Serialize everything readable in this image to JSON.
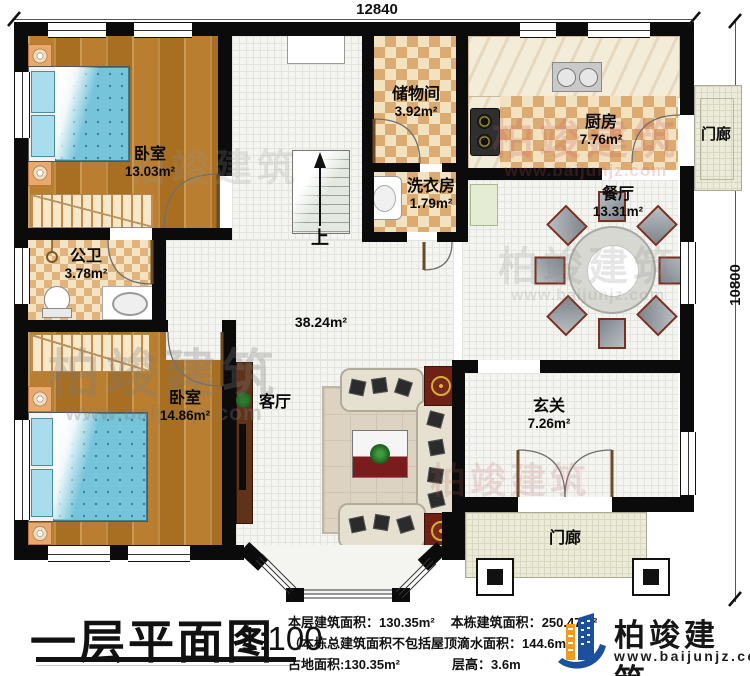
{
  "dimensions": {
    "top": "12840",
    "right": "10800"
  },
  "rooms": {
    "bedroom1": {
      "name": "卧室",
      "area": "13.03m²"
    },
    "storage": {
      "name": "储物间",
      "area": "3.92m²"
    },
    "laundry": {
      "name": "洗衣房",
      "area": "1.79m²"
    },
    "kitchen": {
      "name": "厨房",
      "area": "7.76m²"
    },
    "porch_right": {
      "name": "门廊"
    },
    "dining": {
      "name": "餐厅",
      "area": "13.31m²"
    },
    "bathroom": {
      "name": "公卫",
      "area": "3.78m²"
    },
    "bedroom2": {
      "name": "卧室",
      "area": "14.86m²"
    },
    "living": {
      "name": "客厅"
    },
    "hall": {
      "area": "38.24m²"
    },
    "foyer": {
      "name": "玄关",
      "area": "7.26m²"
    },
    "porch_bottom": {
      "name": "门廊"
    },
    "stairs": {
      "label": "上"
    }
  },
  "footer": {
    "title": "一层平面图",
    "scale": "1:100",
    "floor_area_label": "本层建筑面积：",
    "floor_area_value": "130.35m²",
    "total_area_label": "本栋建筑面积：",
    "total_area_value": "250.47m²",
    "note": "（本栋总建筑面积不包括屋顶滴水面积：144.6m²）",
    "footprint_label": "占地面积:",
    "footprint_value": "130.35m²",
    "height_label": "层高：",
    "height_value": "3.6m"
  },
  "logo": {
    "name": "柏竣建筑",
    "website": "www.baijunjz.com"
  },
  "watermark": {
    "brand": "柏竣建筑",
    "site": "www.baijunjz.com"
  }
}
